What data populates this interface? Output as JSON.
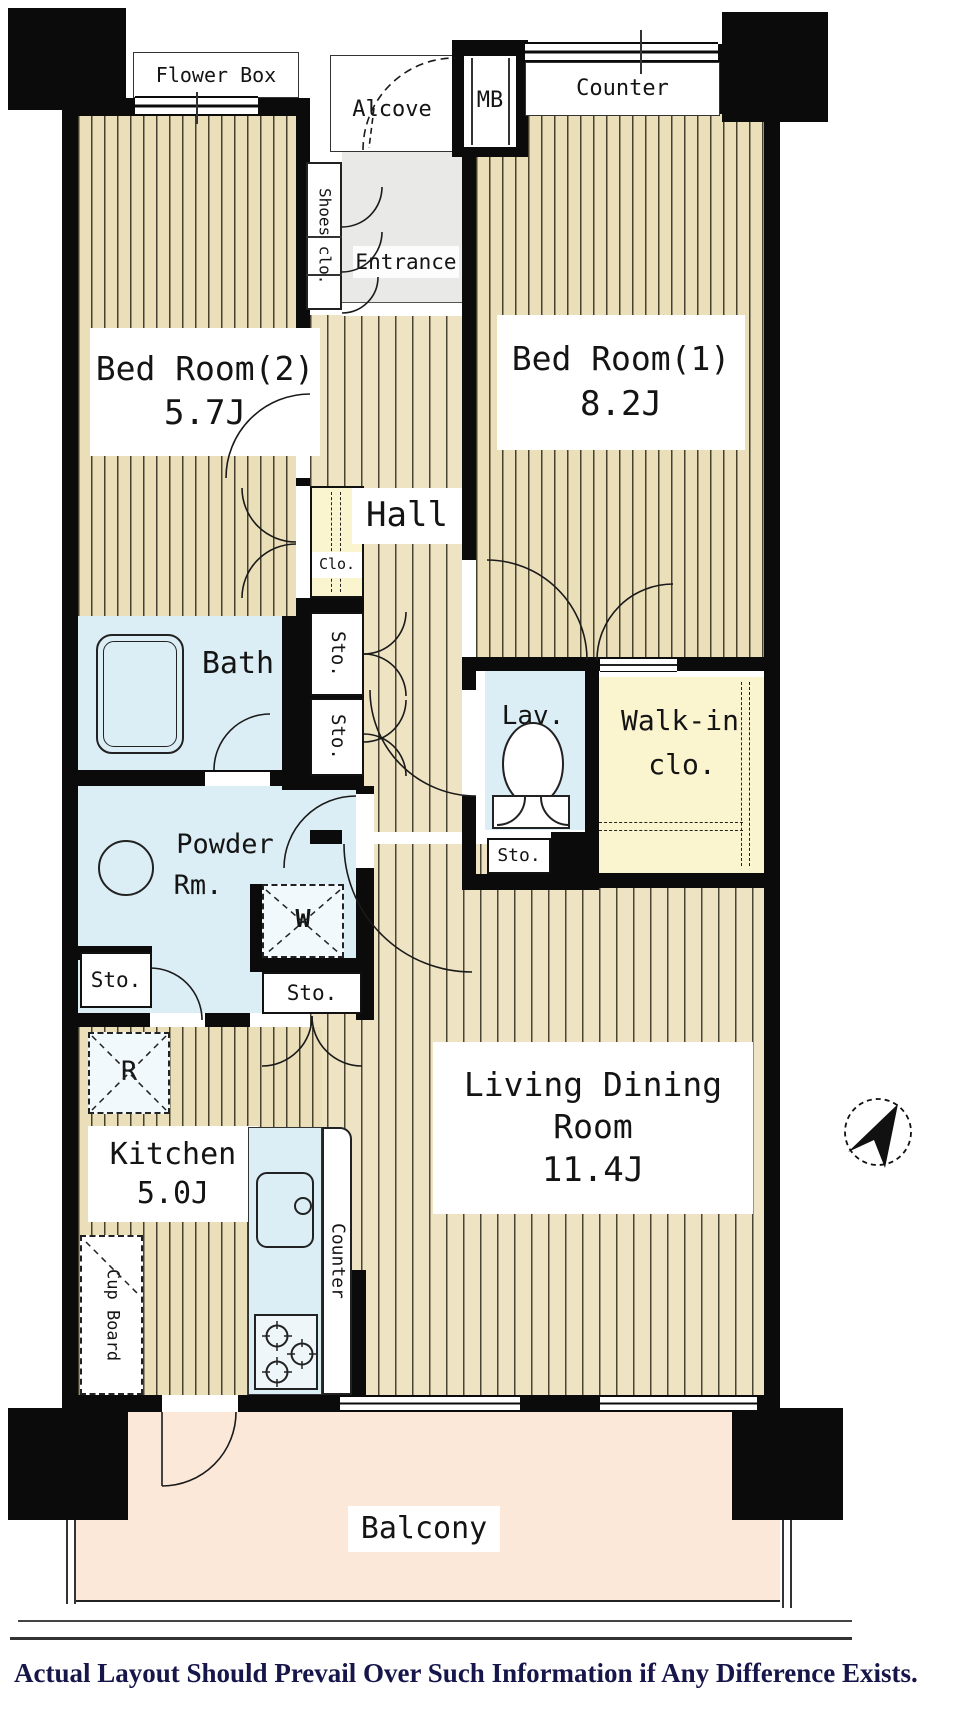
{
  "labels": {
    "flower_box": "Flower Box",
    "alcove": "Alcove",
    "mb": "MB",
    "counter_top": "Counter",
    "shoes_clo": "Shoes clo.",
    "entrance": "Entrance",
    "bedroom2_name": "Bed Room(2)",
    "bedroom2_size": "5.7J",
    "bedroom1_name": "Bed Room(1)",
    "bedroom1_size": "8.2J",
    "clo": "Clo.",
    "hall": "Hall",
    "bath": "Bath",
    "sto_hall_upper": "Sto.",
    "sto_hall_lower": "Sto.",
    "lav": "Lav.",
    "walkin_line1": "Walk-in",
    "walkin_line2": "clo.",
    "sto_lav": "Sto.",
    "powder_line1": "Powder",
    "powder_line2": "Rm.",
    "washer": "W",
    "sto_powder": "Sto.",
    "sto_kitchen": "Sto.",
    "refrigerator": "R",
    "kitchen_name": "Kitchen",
    "kitchen_size": "5.0J",
    "counter_kitchen": "Counter",
    "cup_board": "Cup Board",
    "living_line1": "Living Dining",
    "living_line2": "Room",
    "living_size": "11.4J",
    "balcony": "Balcony",
    "disclaimer": "Actual Layout Should Prevail Over Such Information if Any Difference Exists."
  },
  "colors": {
    "wall": "#0b0b0b",
    "floor_stripe_base": "#ebdfba",
    "floor_stripe_line": "#46412f",
    "water_room": "#dceef5",
    "closet": "#faf4cf",
    "balcony": "#fbe8d9",
    "entrance": "#e9e9e7",
    "disclaimer_text": "#16164a"
  }
}
